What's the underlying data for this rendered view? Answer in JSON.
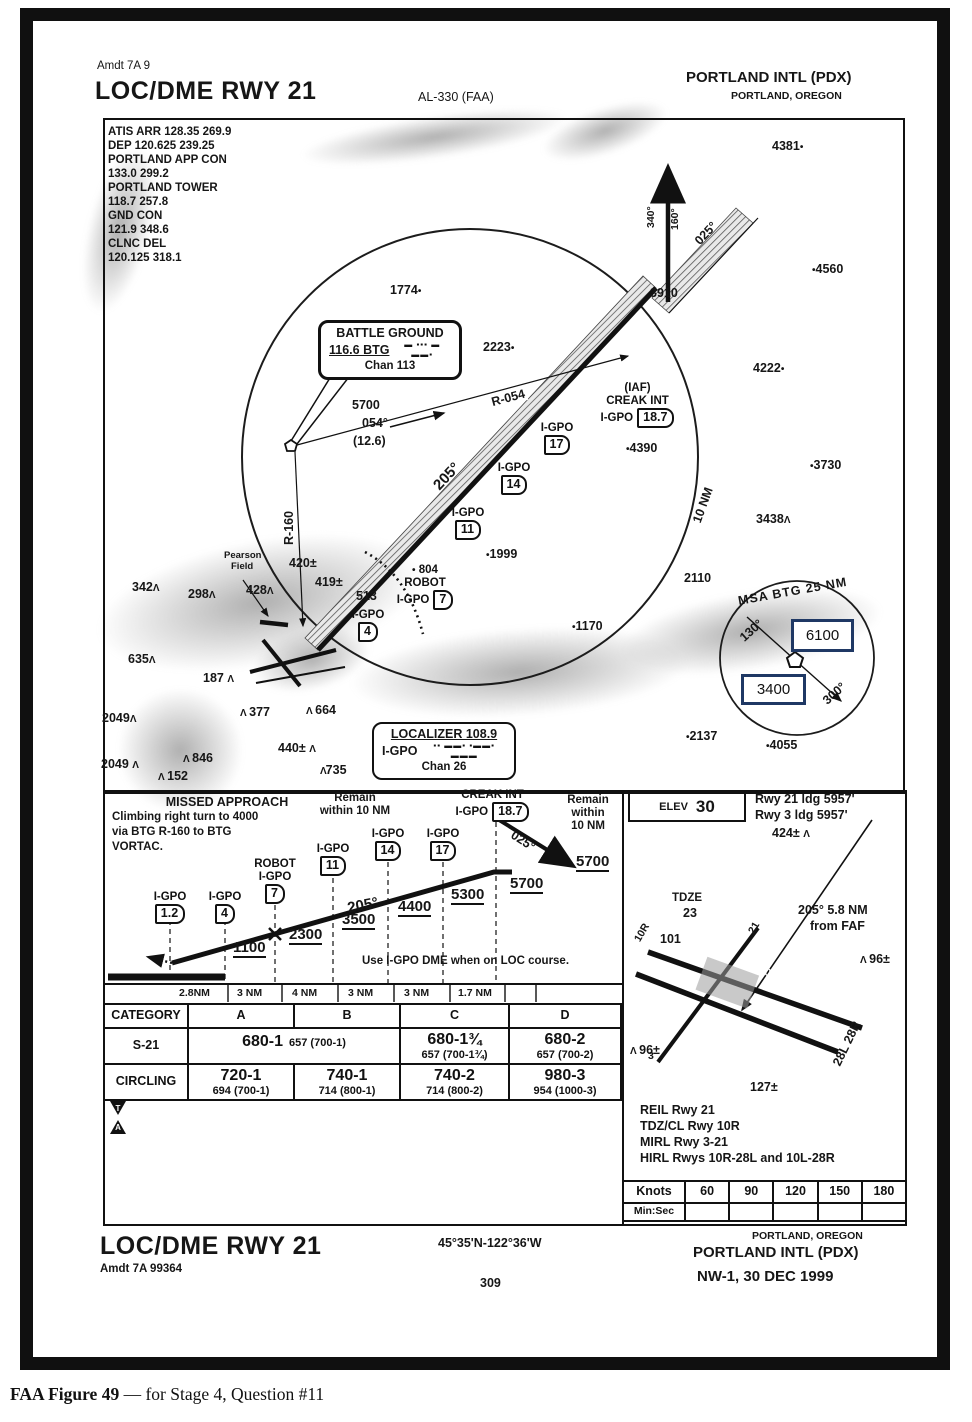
{
  "icons": {
    "obstacle": "Λ",
    "dot": "•",
    "takeoff_symbol": "T",
    "alternate_symbol": "A"
  },
  "header": {
    "amdt": "Amdt 7A 9",
    "title": "LOC/DME RWY 21",
    "al": "AL-330 (FAA)",
    "airport": "PORTLAND INTL (PDX)",
    "city": "PORTLAND, OREGON"
  },
  "comms": {
    "l0": "ATIS ARR 128.35 269.9",
    "l1": "DEP 120.625 239.25",
    "l2": "PORTLAND APP CON",
    "l3": "133.0 299.2",
    "l4": "PORTLAND TOWER",
    "l5": "118.7 257.8",
    "l6": "GND CON",
    "l7": "121.9 348.6",
    "l8": "CLNC DEL",
    "l9": "120.125 318.1"
  },
  "plan": {
    "navaid": {
      "name": "BATTLE GROUND",
      "freq": "116.6 BTG",
      "morse": "▬ ▪▪▪  ▬  ▬▬▪",
      "chan": "Chan 113"
    },
    "loc": {
      "name": "LOCALIZER 108.9",
      "ident": "I-GPO",
      "morse": "▪▪ ▬▬▪ ▪▬▬▪ ▬▬▬",
      "chan": "Chan 26"
    },
    "iaf_tag": "(IAF)",
    "iaf_name": "CREAK INT",
    "iaf_ident": "I-GPO",
    "iaf_dme": "18.7",
    "fix_ident": "I-GPO",
    "fix17": "17",
    "fix14": "14",
    "fix11": "11",
    "fix7": "7",
    "fix4": "4",
    "robot_elev": "804",
    "robot_name": "ROBOT",
    "r054": "R-054",
    "r160": "R-160",
    "feeder_alt": "5700",
    "feeder_crs": "054°",
    "feeder_dist": "(12.6)",
    "loc_crs": "205°",
    "miss_crs": "340°",
    "miss_crs2": "160°",
    "inbound_crs": "025°",
    "ring_label": "10 NM",
    "pearson1": "Pearson",
    "pearson2": "Field",
    "msa": {
      "title": "MSA BTG 25 NM",
      "b1": "130°",
      "b2": "300°",
      "hi": "6100",
      "lo": "3400"
    },
    "spots": [
      "1774",
      "2223",
      "4381",
      "4560",
      "3910",
      "4222",
      "3730",
      "3438",
      "2110",
      "1170",
      "4390",
      "1999",
      "513",
      "420±",
      "419±",
      "428",
      "298",
      "342",
      "635",
      "187",
      "377",
      "664",
      "440±",
      "735",
      "846",
      "152",
      "2049",
      "2049",
      "2137",
      "4055"
    ]
  },
  "profile": {
    "missed_title": "MISSED APPROACH",
    "missed_l1": "Climbing right turn to 4000",
    "missed_l2": "via BTG R-160 to BTG",
    "missed_l3": "VORTAC.",
    "remain_a1": "Remain",
    "remain_a2": "within 10 NM",
    "remain_b1": "Remain",
    "remain_b2": "within",
    "remain_b3": "10 NM",
    "creak_name": "CREAK INT",
    "creak_ident": "I-GPO",
    "creak_dme": "18.7",
    "ident": "I-GPO",
    "robot": "ROBOT",
    "d0": "1.2",
    "d1": "4",
    "d2": "7",
    "d3": "11",
    "d4": "14",
    "d5": "17",
    "a0": "1100",
    "a1": "2300",
    "a2": "3500",
    "a3": "4400",
    "a4": "5300",
    "a5": "5700",
    "a6": "5700",
    "crs": "205°",
    "inbound": "025°",
    "note": "Use I-GPO DME when on LOC course.",
    "dist0": "2.8NM",
    "dist1": "3 NM",
    "dist2": "4 NM",
    "dist3": "3 NM",
    "dist4": "3 NM",
    "dist5": "1.7 NM"
  },
  "minimums": {
    "h0": "CATEGORY",
    "h1": "A",
    "h2": "B",
    "h3": "C",
    "h4": "D",
    "s21": {
      "label": "S-21",
      "ab": "680-1",
      "ab_sub": "657 (700-1)",
      "c": "680-1¾",
      "c_sub": "657 (700-1¾)",
      "d": "680-2",
      "d_sub": "657 (700-2)"
    },
    "circling": {
      "label": "CIRCLING",
      "a": "720-1",
      "a_sub": "694 (700-1)",
      "b": "740-1",
      "b_sub": "714 (800-1)",
      "c": "740-2",
      "c_sub": "714 (800-2)",
      "d": "980-3",
      "d_sub": "954 (1000-3)"
    }
  },
  "sketch": {
    "elev_label": "ELEV",
    "elev_value": "30",
    "rwy21_ldg": "Rwy 21 ldg 5957'",
    "rwy3_ldg": "Rwy 3 ldg 5957'",
    "obst424": "424±",
    "tdze_label": "TDZE",
    "tdze_value": "23",
    "spot101": "101",
    "faf_l1": "205° 5.8 NM",
    "faf_l2": "from FAF",
    "rwy_dim": "8000 X 150",
    "rwy2828": "28L 28R",
    "rwy10r": "10R",
    "rwy3": "3",
    "rwy21": "21",
    "obst96a": "96±",
    "obst96b": "96±",
    "obst127": "127±",
    "light0": "REIL Rwy 21",
    "light1": "TDZ/CL Rwy 10R",
    "light2": "MIRL Rwy 3-21",
    "light3": "HIRL Rwys 10R-28L and 10L-28R"
  },
  "timetable": {
    "c0": "Knots",
    "c1": "60",
    "c2": "90",
    "c3": "120",
    "c4": "150",
    "c5": "180",
    "r0": "Min:Sec"
  },
  "footer": {
    "title": "LOC/DME RWY 21",
    "amdt": "Amdt 7A 99364",
    "coords": "45°35'N-122°36'W",
    "page": "309",
    "city": "PORTLAND, OREGON",
    "airport": "PORTLAND INTL (PDX)",
    "edition": "NW-1, 30 DEC 1999"
  },
  "caption": {
    "bold": "FAA Figure 49",
    "rest": " — for Stage 4, Question #11"
  }
}
